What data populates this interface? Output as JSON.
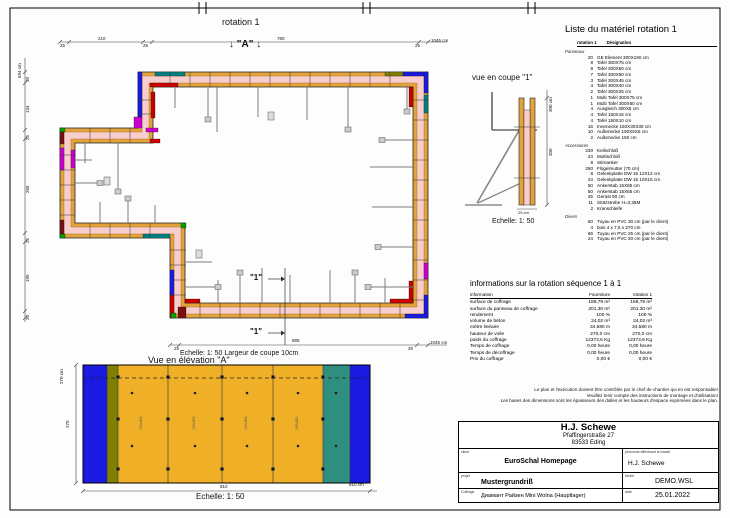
{
  "plan": {
    "title": "rotation 1",
    "section_a": "↓ \"A\" ↓",
    "section_1": "\"1\"",
    "scale_note": "Echelle: 1: 50   Largeur de coupe 10cm",
    "dims_top": [
      "25",
      "210",
      "25",
      "760",
      "25",
      "1045 cm"
    ],
    "dims_left": [
      "694 cm",
      "30",
      "134",
      "25",
      "265",
      "25",
      "195",
      "20"
    ],
    "dims_bottom": [
      "25",
      "885",
      "30",
      "1045 cm"
    ]
  },
  "coupe": {
    "title": "vue en coupe \"1\"",
    "dim_total": "300 cm",
    "dim_height": "300",
    "dim_width": "25 cm",
    "scale": "Echelle: 1: 50"
  },
  "material_list": {
    "title": "Liste du matériel  rotation 1",
    "col_qty": "rotation 1",
    "col_name": "Désignation",
    "groups": [
      {
        "name": "Panneaux",
        "items": [
          [
            "20",
            "GE Element 300X150 cm"
          ],
          [
            "8",
            "Tafel 300X75 cm"
          ],
          [
            "8",
            "Tafel 300X60 cm"
          ],
          [
            "7",
            "Tafel 300X50 cm"
          ],
          [
            "3",
            "Tafel 300X45 cm"
          ],
          [
            "4",
            "Tafel 300X40 cm"
          ],
          [
            "2",
            "Tafel 300X25 cm"
          ],
          [
            "1",
            "Multi Tafel 300X75 cm"
          ],
          [
            "1",
            "Multi Tafel 300X60 cm"
          ],
          [
            "4",
            "Ausgleich 300X5 cm"
          ],
          [
            "4",
            "Tafel 150X15 cm"
          ],
          [
            "4",
            "Tafel 150X10 cm"
          ],
          [
            "16",
            "Innenecke 150X30X30 cm"
          ],
          [
            "10",
            "Außenecke 150X5X5 cm"
          ],
          [
            "2",
            "Außenecke 150 cm"
          ]
        ]
      },
      {
        "name": "Accessoires",
        "items": [
          [
            "230",
            "Keilschloß"
          ],
          [
            "24",
            "Multischloß"
          ],
          [
            "8",
            "Stirnanker"
          ],
          [
            "260",
            "Flügelmutter (70 cm)"
          ],
          [
            "8",
            "Gelenkplatte DW 15 12X12 cm"
          ],
          [
            "24",
            "Gelenkplatte DW 15 10X15 cm"
          ],
          [
            "60",
            "Ankerstab 15X85 cm"
          ],
          [
            "50",
            "Ankerstab 15X65 cm"
          ],
          [
            "25",
            "Gerüst 90 cm"
          ],
          [
            "11",
            "Stützstrebe H=3,35M"
          ],
          [
            "2",
            "Kranschleife"
          ]
        ]
      },
      {
        "name": "Divers",
        "items": [
          [
            "60",
            "Tuyau en PVC 30 cm (par le client)"
          ],
          [
            "4",
            "bois 4 x 7,5 x 270 cm"
          ],
          [
            "66",
            "Tuyau en PVC 25 cm (par le client)"
          ],
          [
            "24",
            "Tuyau en PVC 20 cm (par le client)"
          ]
        ]
      }
    ]
  },
  "info_table": {
    "title": "informations sur la rotation  séquence 1 à 1",
    "columns": [
      "information",
      "Fourniture",
      "rotation 1"
    ],
    "rows": [
      [
        "surface de coffrage",
        "188,79 m²",
        "188,79 m²"
      ],
      [
        "surface du panneau de coffrage",
        "201,30 m²",
        "201,30 m²"
      ],
      [
        "rendement",
        "100 %",
        "100 %"
      ],
      [
        "volume de béton",
        "24,02 m³",
        "24,02 m³"
      ],
      [
        "mètre linéaire",
        "34.580 m",
        "34.580 m"
      ],
      [
        "hauteur de voile",
        "270,0 cm",
        "270,0 cm"
      ],
      [
        "poids du coffrage",
        "12373,6 Kg",
        "12373,6 Kg"
      ],
      [
        "Temps de coffrage",
        "0,00 heure",
        "0,00 heure"
      ],
      [
        "Temps de décoffrage",
        "0,00 heure",
        "0,00 heure"
      ],
      [
        "Prix du coffrage",
        "0,00 €",
        "0,00 €"
      ]
    ]
  },
  "disclaimer_lines": [
    "Le plan et l'exécution doivent être contrôlés par le chef de chantier qui en est responsable!",
    "Veuillez tenir compte des instructions de montage et d'utilisation!",
    "Les bases des dimensions sont les épaisseurs des dalles et les hauteurs d'espace exprimées dans le plan."
  ],
  "elevation": {
    "title": "Vue en élévation \"A\"",
    "dim_total_h": "270 cm",
    "dim_h": "270",
    "dim_w": "810",
    "dim_total_w": "810 cm",
    "scale": "Echelle: 1: 50",
    "panel_label": "150x300"
  },
  "title_block": {
    "company": "H.J. Schewe",
    "address1": "Pfaffingerstraße 27",
    "address2": "83533 Eding",
    "client_label": "client",
    "client": "EuroSchal Homepage",
    "worker_label": "personne effectuant le travail",
    "worker": "H.J. Schewe",
    "project_label": "projet",
    "project": "Mustergrundriß",
    "file_label": "fichier",
    "file": "DEMO.WSL",
    "formwork_label": "Coffrage",
    "formwork": "Диамант Райзен Mini Wolna (Hauptlager)",
    "date_label": "date",
    "date": "25.01.2022"
  },
  "colors": {
    "wall_pink": "#f8cdcd",
    "panel_yellow": "#e2a33c",
    "accent_blue": "#1a1ae0",
    "accent_teal": "#008080",
    "accent_magenta": "#cc00cc",
    "accent_red": "#cc0000",
    "accent_green": "#00a000",
    "accent_maroon": "#7a0f0f",
    "accent_olive": "#7f7f00",
    "elevation_yellow": "#efb028",
    "elevation_teal": "#2f9080",
    "brace_gray": "#7d7d7d"
  }
}
